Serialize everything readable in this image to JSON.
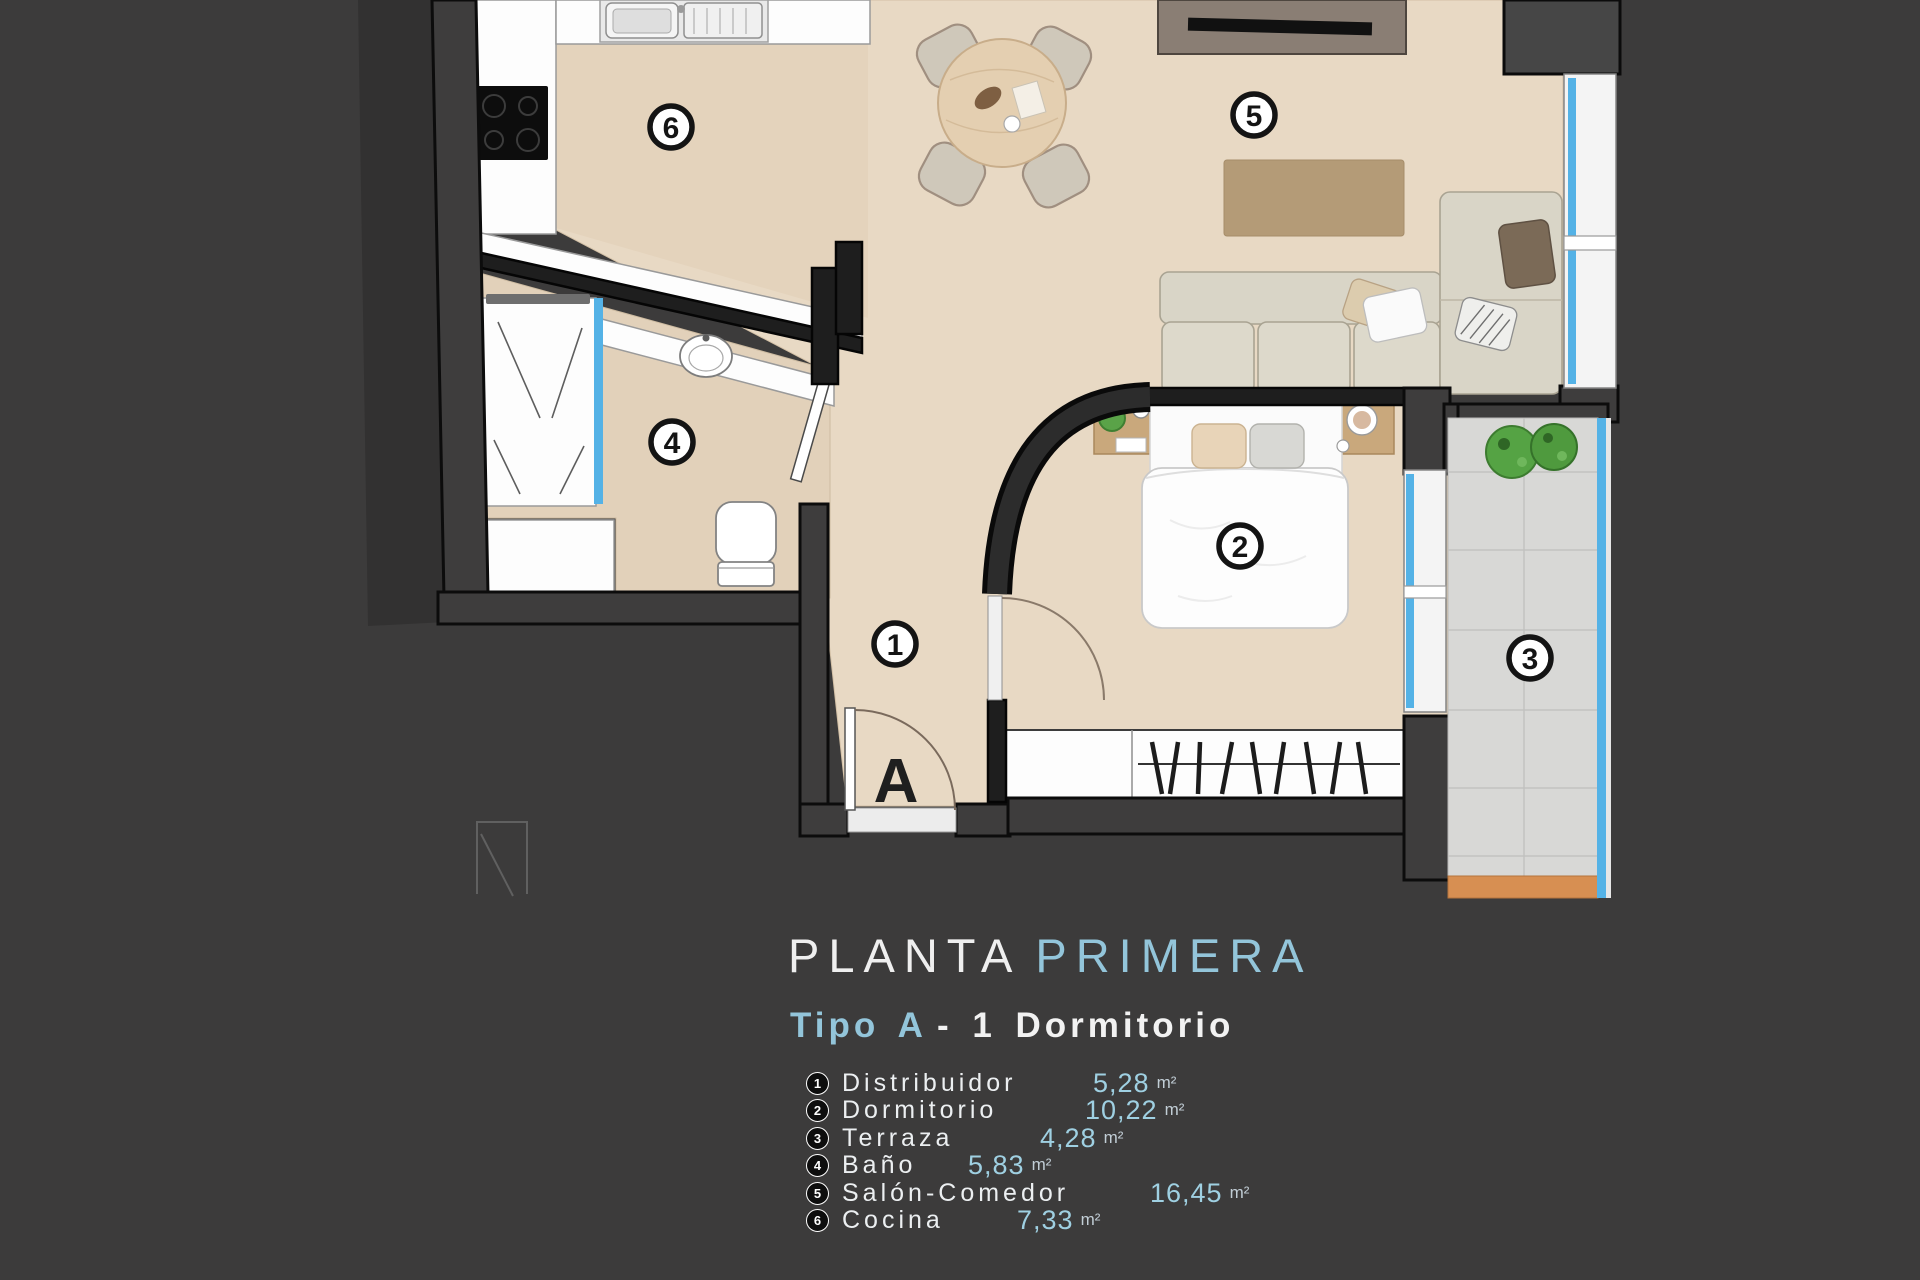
{
  "colors": {
    "background": "#3C3B3B",
    "accent_blue": "#93C5DA",
    "glass_blue": "#54B2E6",
    "floor_beige": "#E8D9C4",
    "terrace_gray": "#D8D8D6",
    "rug_tan": "#B49B77",
    "wall_dark": "#1E1E1E"
  },
  "title": {
    "part1": "PLANTA",
    "part2": "PRIMERA"
  },
  "subtitle": {
    "highlight": "Tipo A",
    "rest": "- 1 Dormitorio"
  },
  "legend": {
    "items": [
      {
        "num": "1",
        "name": "Distribuidor",
        "value": "5,28",
        "unit": "m²"
      },
      {
        "num": "2",
        "name": "Dormitorio",
        "value": "10,22",
        "unit": "m²"
      },
      {
        "num": "3",
        "name": "Terraza",
        "value": "4,28",
        "unit": "m²"
      },
      {
        "num": "4",
        "name": "Baño",
        "value": "5,83",
        "unit": "m²"
      },
      {
        "num": "5",
        "name": "Salón-Comedor",
        "value": "16,45",
        "unit": "m²"
      },
      {
        "num": "6",
        "name": "Cocina",
        "value": "7,33",
        "unit": "m²"
      }
    ]
  },
  "plan": {
    "entrance_label": "A",
    "markers": [
      {
        "num": "1",
        "room": "Distribuidor"
      },
      {
        "num": "2",
        "room": "Dormitorio"
      },
      {
        "num": "3",
        "room": "Terraza"
      },
      {
        "num": "4",
        "room": "Baño"
      },
      {
        "num": "5",
        "room": "Salón-Comedor"
      },
      {
        "num": "6",
        "room": "Cocina"
      }
    ]
  }
}
